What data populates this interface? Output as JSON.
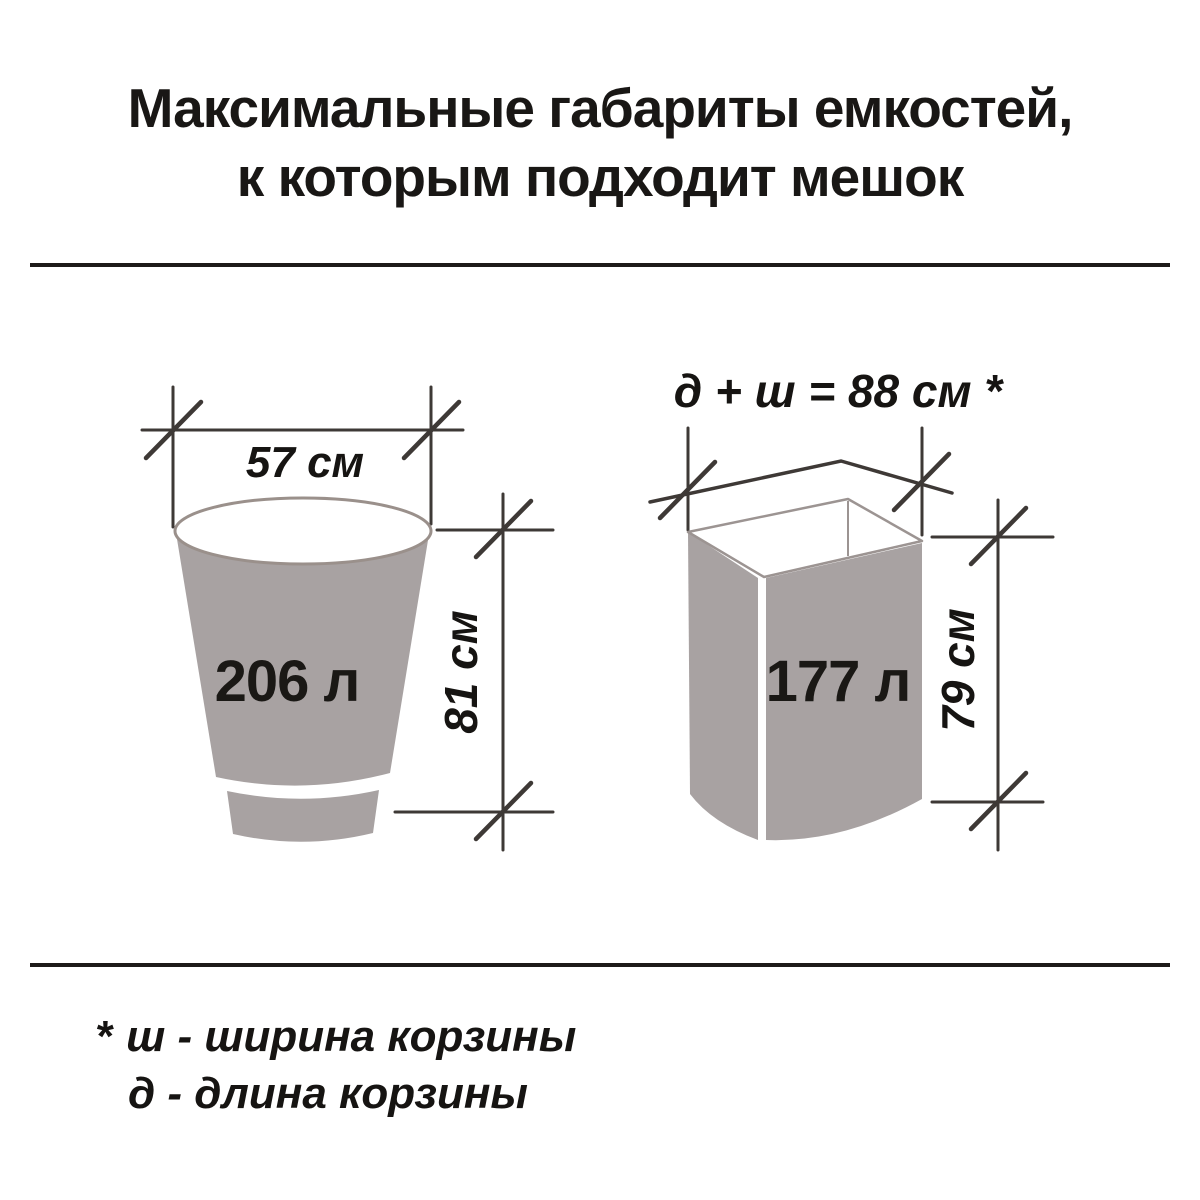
{
  "title": {
    "line1": "Максимальные габариты емкостей,",
    "line2": "к которым подходит мешок"
  },
  "bucket_diagram": {
    "width_label": "57 см",
    "volume_label": "206 л",
    "height_label": "81 см"
  },
  "box_diagram": {
    "dimension_formula_label": "д + ш = 88 см *",
    "volume_label": "177 л",
    "height_label": "79 см"
  },
  "footnote": {
    "marker": "*",
    "width_definition": "ш - ширина корзины",
    "length_definition": "д - длина корзины"
  },
  "colors": {
    "container_fill": "#A8A2A2",
    "rim_stroke": "#9A908B",
    "dimension_line": "#3E3936",
    "text": "#161412"
  }
}
